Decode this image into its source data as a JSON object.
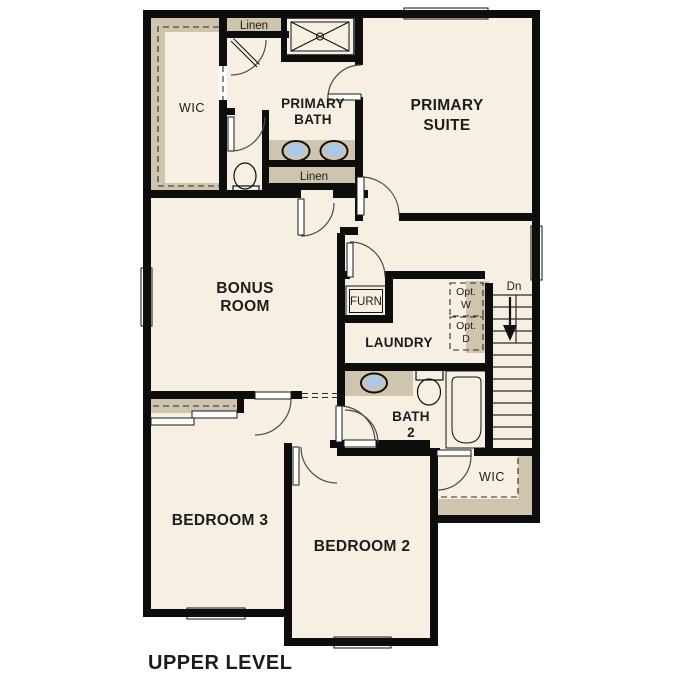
{
  "plan": {
    "title": "UPPER LEVEL"
  },
  "rooms": {
    "primary_suite": {
      "lines": [
        "PRIMARY",
        "SUITE"
      ]
    },
    "primary_bath": {
      "lines": [
        "PRIMARY",
        "BATH"
      ]
    },
    "bonus_room": {
      "lines": [
        "BONUS",
        "ROOM"
      ]
    },
    "bath_2": {
      "lines": [
        "BATH",
        "2"
      ]
    },
    "laundry": {
      "label": "LAUNDRY"
    },
    "bedroom_3": {
      "label": "BEDROOM 3"
    },
    "bedroom_2": {
      "label": "BEDROOM 2"
    },
    "wic_primary": {
      "label": "WIC"
    },
    "wic_bedroom2": {
      "label": "WIC"
    }
  },
  "closets": {
    "linen_top": {
      "label": "Linen"
    },
    "linen_bath": {
      "label": "Linen"
    }
  },
  "equipment": {
    "furnace": {
      "label": "FURN"
    },
    "optional_washer": {
      "lines": [
        "Opt.",
        "W"
      ]
    },
    "optional_dryer": {
      "lines": [
        "Opt.",
        "D"
      ]
    }
  },
  "stairs": {
    "direction_label": "Dn"
  },
  "colors": {
    "floor": "#f7efe2",
    "cabinet_tan": "#cfc4ae",
    "fixture_blue": "#a9c9e9",
    "appliance_gray": "#d9d9d9",
    "wall_black": "#0d0d0d",
    "text": "#1c1c1c"
  }
}
